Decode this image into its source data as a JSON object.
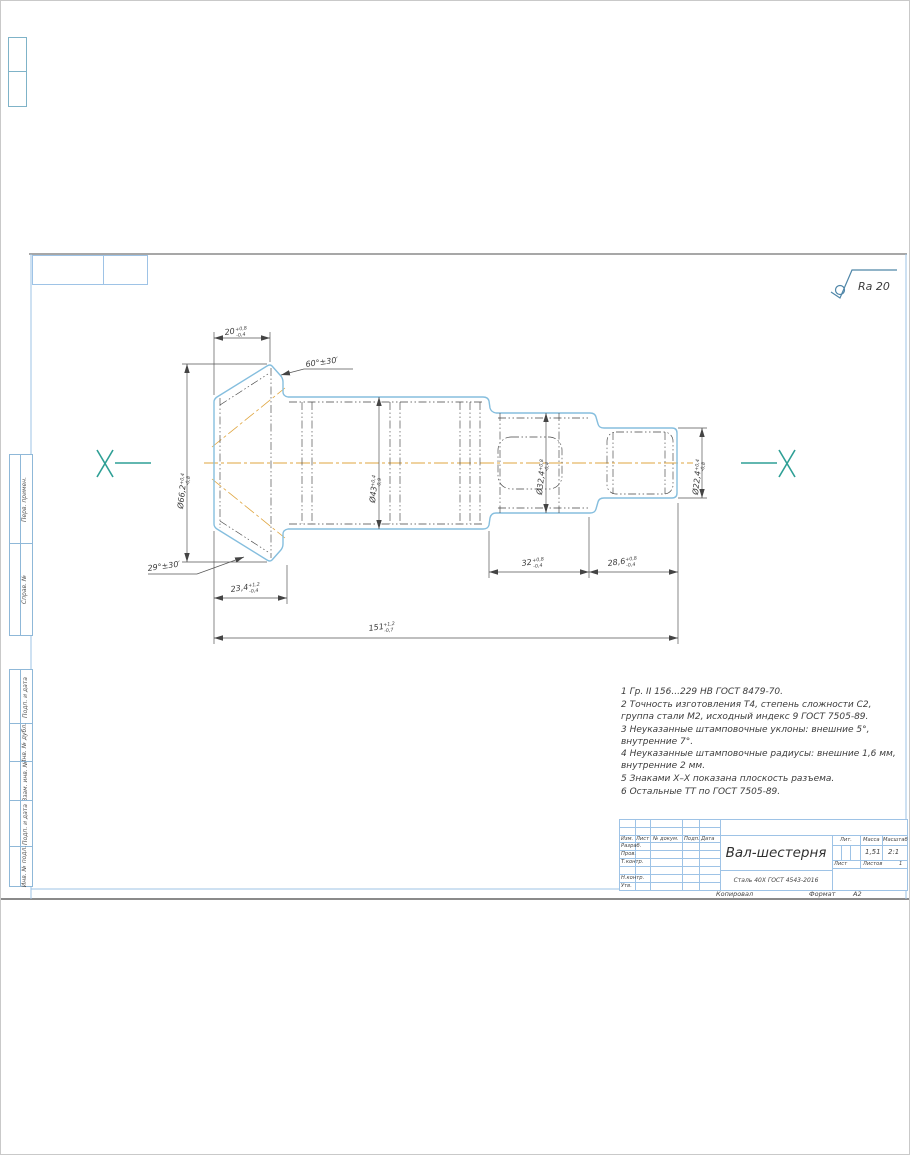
{
  "frame": {
    "margin_labels": [
      "Перв. примен.",
      "Справ. №",
      "Подп. и дата",
      "Инв. № дубл.",
      "Взам. инв. №",
      "Подп. и дата",
      "Инв. № подл."
    ],
    "copied": "Копировал",
    "format_label": "Формат",
    "format_value": "А2"
  },
  "drawing": {
    "roughness": "Ra 20",
    "section_mark": "X",
    "dims": {
      "len20": {
        "v": "20",
        "sup": "+0,8",
        "sub": "-0,4"
      },
      "len23": {
        "v": "23,4",
        "sup": "+1,2",
        "sub": "-0,4"
      },
      "len32": {
        "v": "32",
        "sup": "+0,8",
        "sub": "-0,4"
      },
      "len28": {
        "v": "28,6",
        "sup": "+0,8",
        "sub": "-0,4"
      },
      "len151": {
        "v": "151",
        "sup": "+1,2",
        "sub": "-0,7"
      },
      "d66": {
        "v": "Ø66,2",
        "sup": "+0,4",
        "sub": "-0,8"
      },
      "d43": {
        "v": "Ø43",
        "sup": "+0,4",
        "sub": "-0,9"
      },
      "d32": {
        "v": "Ø32,4",
        "sup": "+0,8",
        "sub": "-0,4"
      },
      "d22": {
        "v": "Ø22,4",
        "sup": "+0,4",
        "sub": "-0,8"
      },
      "ang60": "60°±30′",
      "ang29": "29°±30′"
    }
  },
  "notes": [
    "1 Гр. II 156...229 НВ ГОСТ 8479-70.",
    "2 Точность изготовления Т4, степень сложности С2, группа стали М2, исходный индекс 9 ГОСТ 7505-89.",
    "3 Неуказанные штамповочные уклоны: внешние 5°, внутренние 7°.",
    "4 Неуказанные штамповочные радиусы: внешние 1,6 мм, внутренние 2 мм.",
    "5 Знаками Х–Х показана плоскость разъема.",
    "6 Остальные ТТ по ГОСТ 7505-89."
  ],
  "title_block": {
    "part_name": "Вал-шестерня",
    "material": "Сталь 40Х ГОСТ 4543-2016",
    "col_headers": {
      "izm": "Изм.",
      "list": "Лист",
      "doc": "№ докум.",
      "podp": "Подп.",
      "data": "Дата"
    },
    "rows": [
      "Разраб.",
      "Пров.",
      "Т.контр.",
      "",
      "Н.контр.",
      "Утв."
    ],
    "lit_label": "Лит.",
    "mass_label": "Масса",
    "scale_label": "Масштаб",
    "mass_value": "1,51",
    "scale_value": "2:1",
    "sheet_label": "Лист",
    "sheets_label": "Листов",
    "sheets_value": "1"
  }
}
